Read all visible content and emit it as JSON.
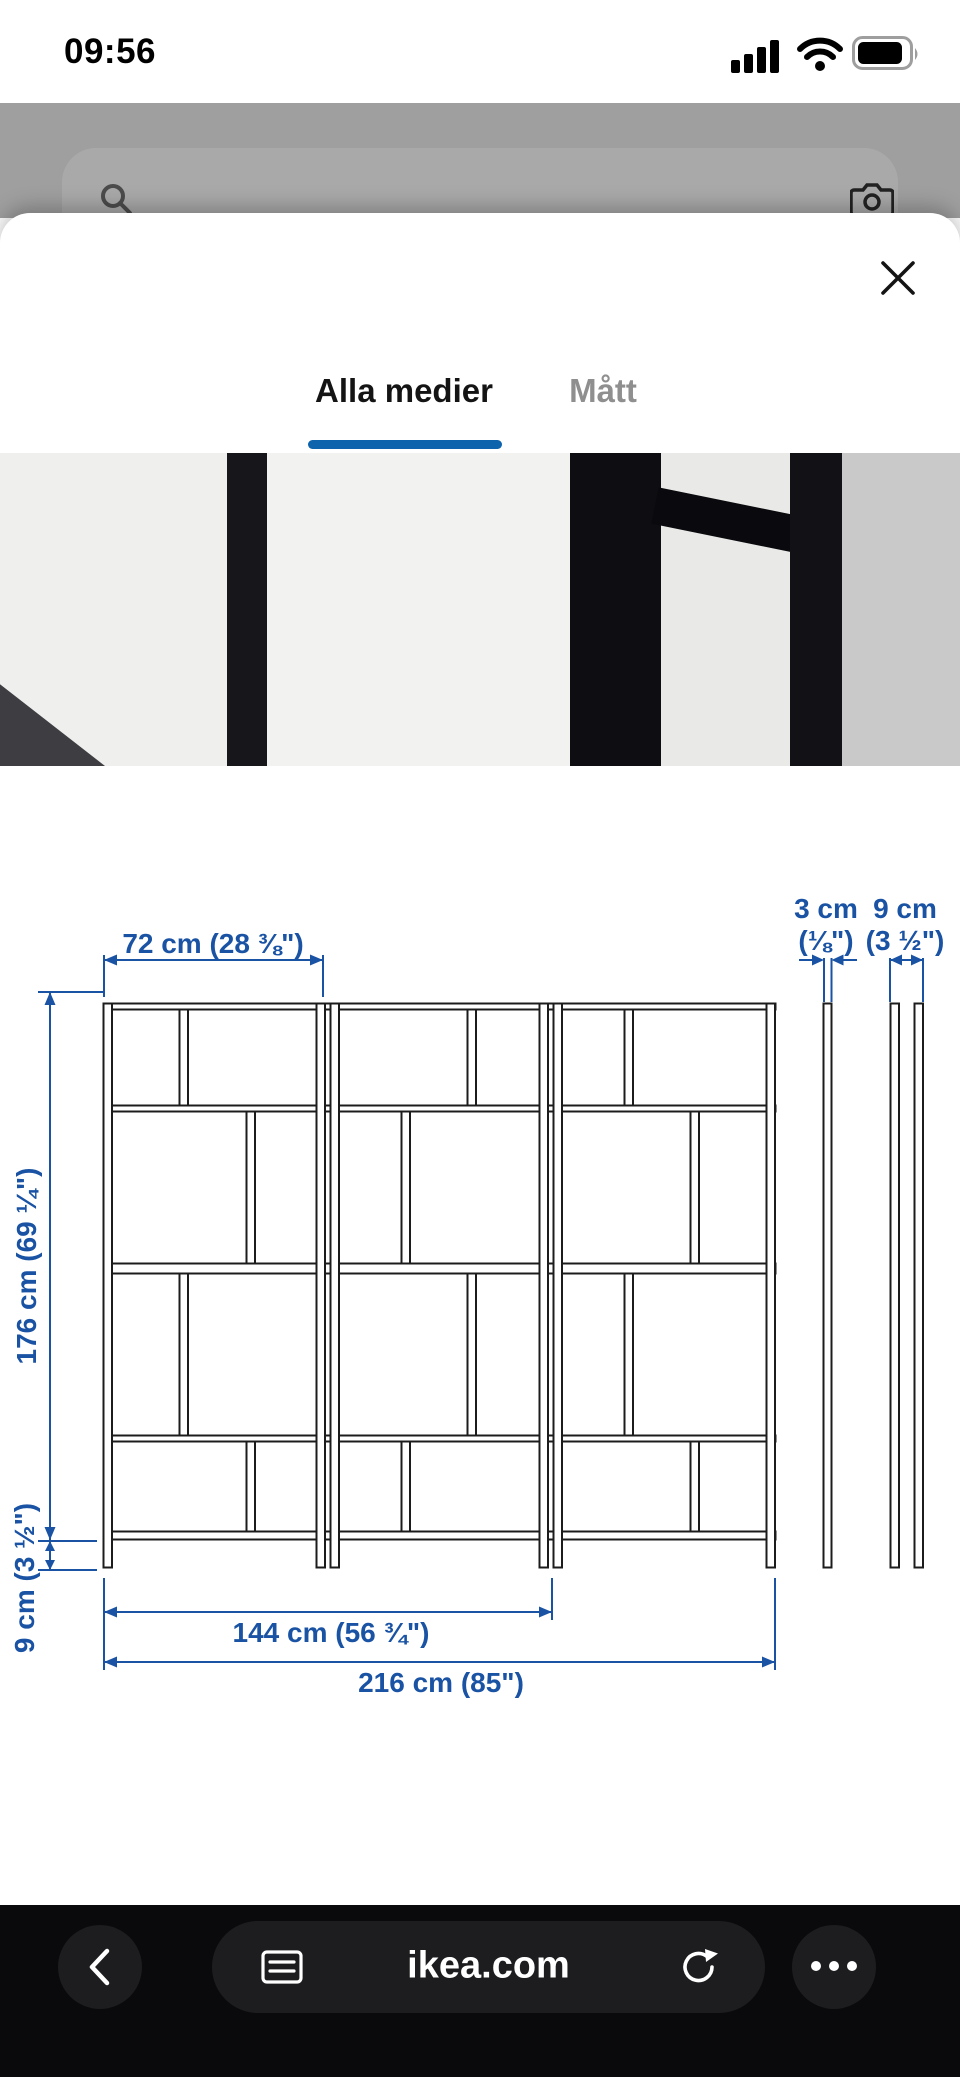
{
  "status_bar": {
    "time": "09:56"
  },
  "browser_page": {
    "search_placeholder": "Vad letar du efter?"
  },
  "modal": {
    "tabs": [
      {
        "label": "Alla medier",
        "active": true
      },
      {
        "label": "Mått",
        "active": false
      }
    ],
    "close_label": "close"
  },
  "diagram": {
    "labels": {
      "section_width": "72 cm (28 ⅜\")",
      "panel_thickness_cm": "3 cm",
      "panel_thickness_in": "(⅛\")",
      "depth_cm": "9 cm",
      "depth_in": "(3 ½\")",
      "total_height": "176 cm (69 ¼\")",
      "base_height": "9 cm (3 ½\")",
      "two_section_width": "144 cm (56 ¾\")",
      "total_width": "216 cm (85\")"
    },
    "colors": {
      "dimension_blue": "#1a53a4",
      "frame_black": "#1c1c1c"
    }
  },
  "toolbar": {
    "url": "ikea.com"
  },
  "theme": {
    "tab_underline_blue": "#0e63ad",
    "toolbar_bg": "#0a0a0c"
  }
}
